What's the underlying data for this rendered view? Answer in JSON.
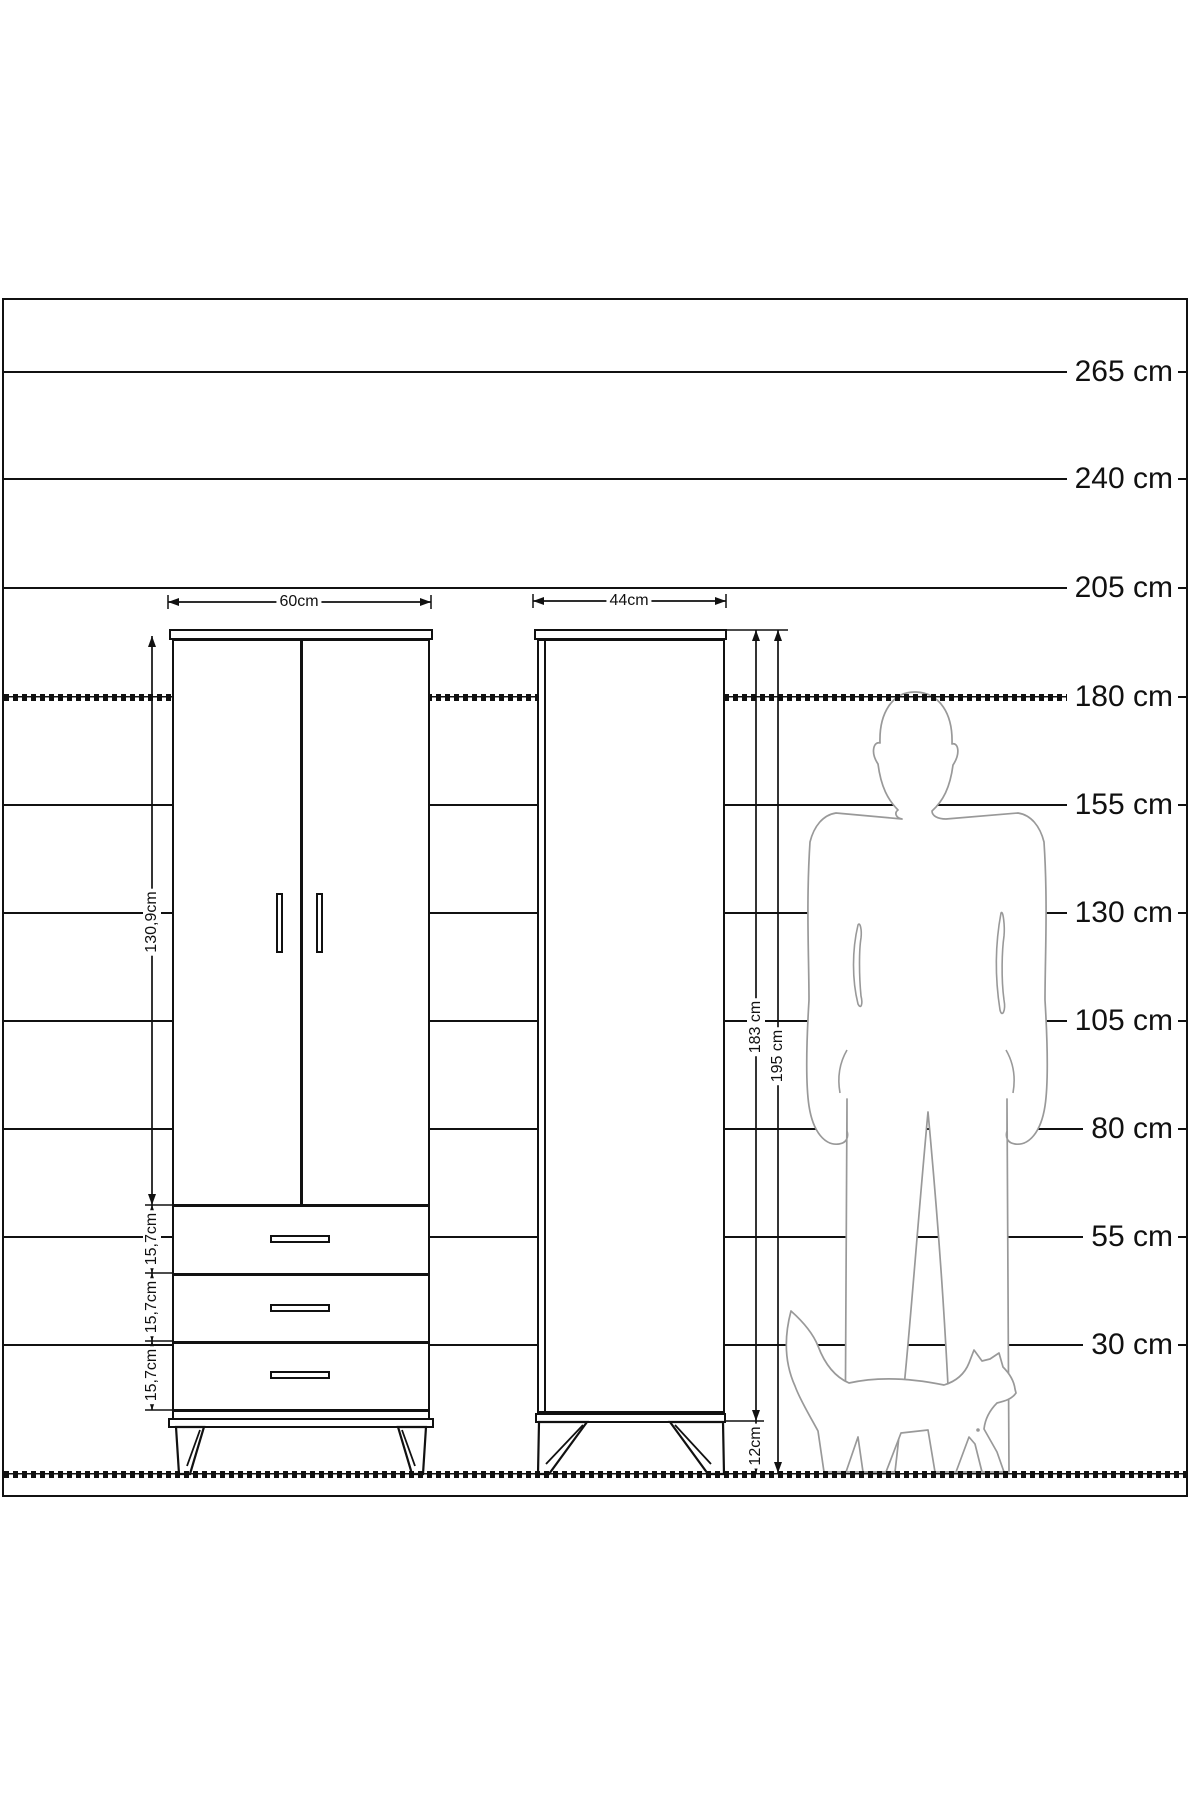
{
  "scale_labels": [
    "265 cm",
    "240 cm",
    "205 cm",
    "180 cm",
    "155 cm",
    "130 cm",
    "105 cm",
    "80 cm",
    "55 cm",
    "30 cm"
  ],
  "front_view": {
    "width": "60cm",
    "door_height": "130,9cm",
    "drawers": [
      "15,7cm",
      "15,7cm",
      "15,7cm"
    ]
  },
  "side_view": {
    "depth": "44cm",
    "body_height": "183 cm",
    "total_height": "195 cm",
    "leg_height": "12cm"
  },
  "colors": {
    "line": "#111111",
    "silhouette": "#999999",
    "background": "#ffffff"
  }
}
